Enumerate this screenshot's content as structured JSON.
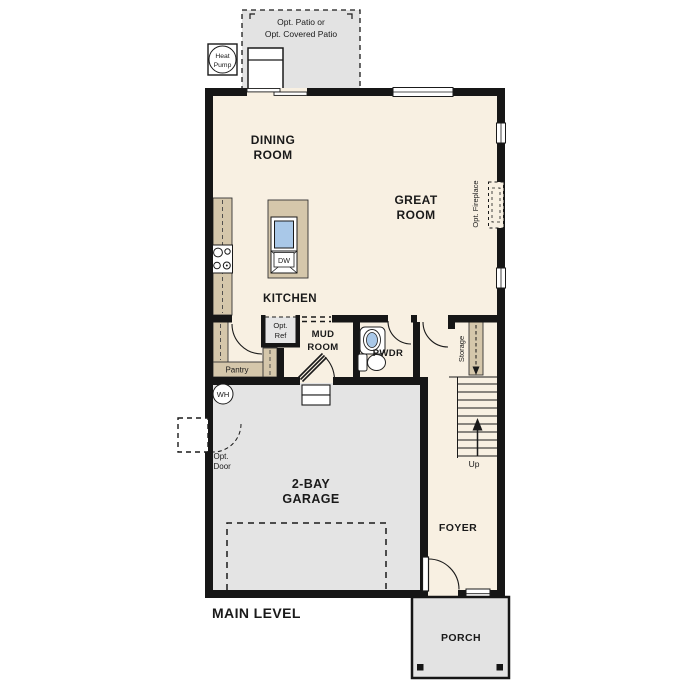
{
  "plan_title": "MAIN LEVEL",
  "rooms": {
    "dining": {
      "line1": "DINING",
      "line2": "ROOM"
    },
    "great": {
      "line1": "GREAT",
      "line2": "ROOM"
    },
    "kitchen": {
      "label": "KITCHEN"
    },
    "mud": {
      "line1": "MUD",
      "line2": "ROOM"
    },
    "powder": {
      "label": "PWDR"
    },
    "garage": {
      "line1": "2-BAY",
      "line2": "GARAGE"
    },
    "foyer": {
      "label": "FOYER"
    },
    "porch": {
      "label": "PORCH"
    }
  },
  "annotations": {
    "patio": {
      "line1": "Opt. Patio or",
      "line2": "Opt. Covered Patio"
    },
    "heat_pump": {
      "line1": "Heat",
      "line2": "Pump"
    },
    "opt_ref": {
      "line1": "Opt.",
      "line2": "Ref"
    },
    "opt_door": {
      "line1": "Opt.",
      "line2": "Door"
    },
    "pantry": {
      "label": "Pantry"
    },
    "storage": {
      "label": "Storage"
    },
    "opt_fireplace": {
      "label": "Opt. Fireplace"
    },
    "stairs_up": {
      "label": "Up"
    },
    "water_heater": {
      "label": "WH"
    },
    "dishwasher": {
      "label": "DW"
    }
  },
  "colors": {
    "floor": "#f8f0e2",
    "cabinet": "#d5c7ab",
    "concrete": "#e3e3e3",
    "wall": "#161616",
    "sink_blue": "#a9c8e8",
    "text": "#1a1a1a"
  }
}
